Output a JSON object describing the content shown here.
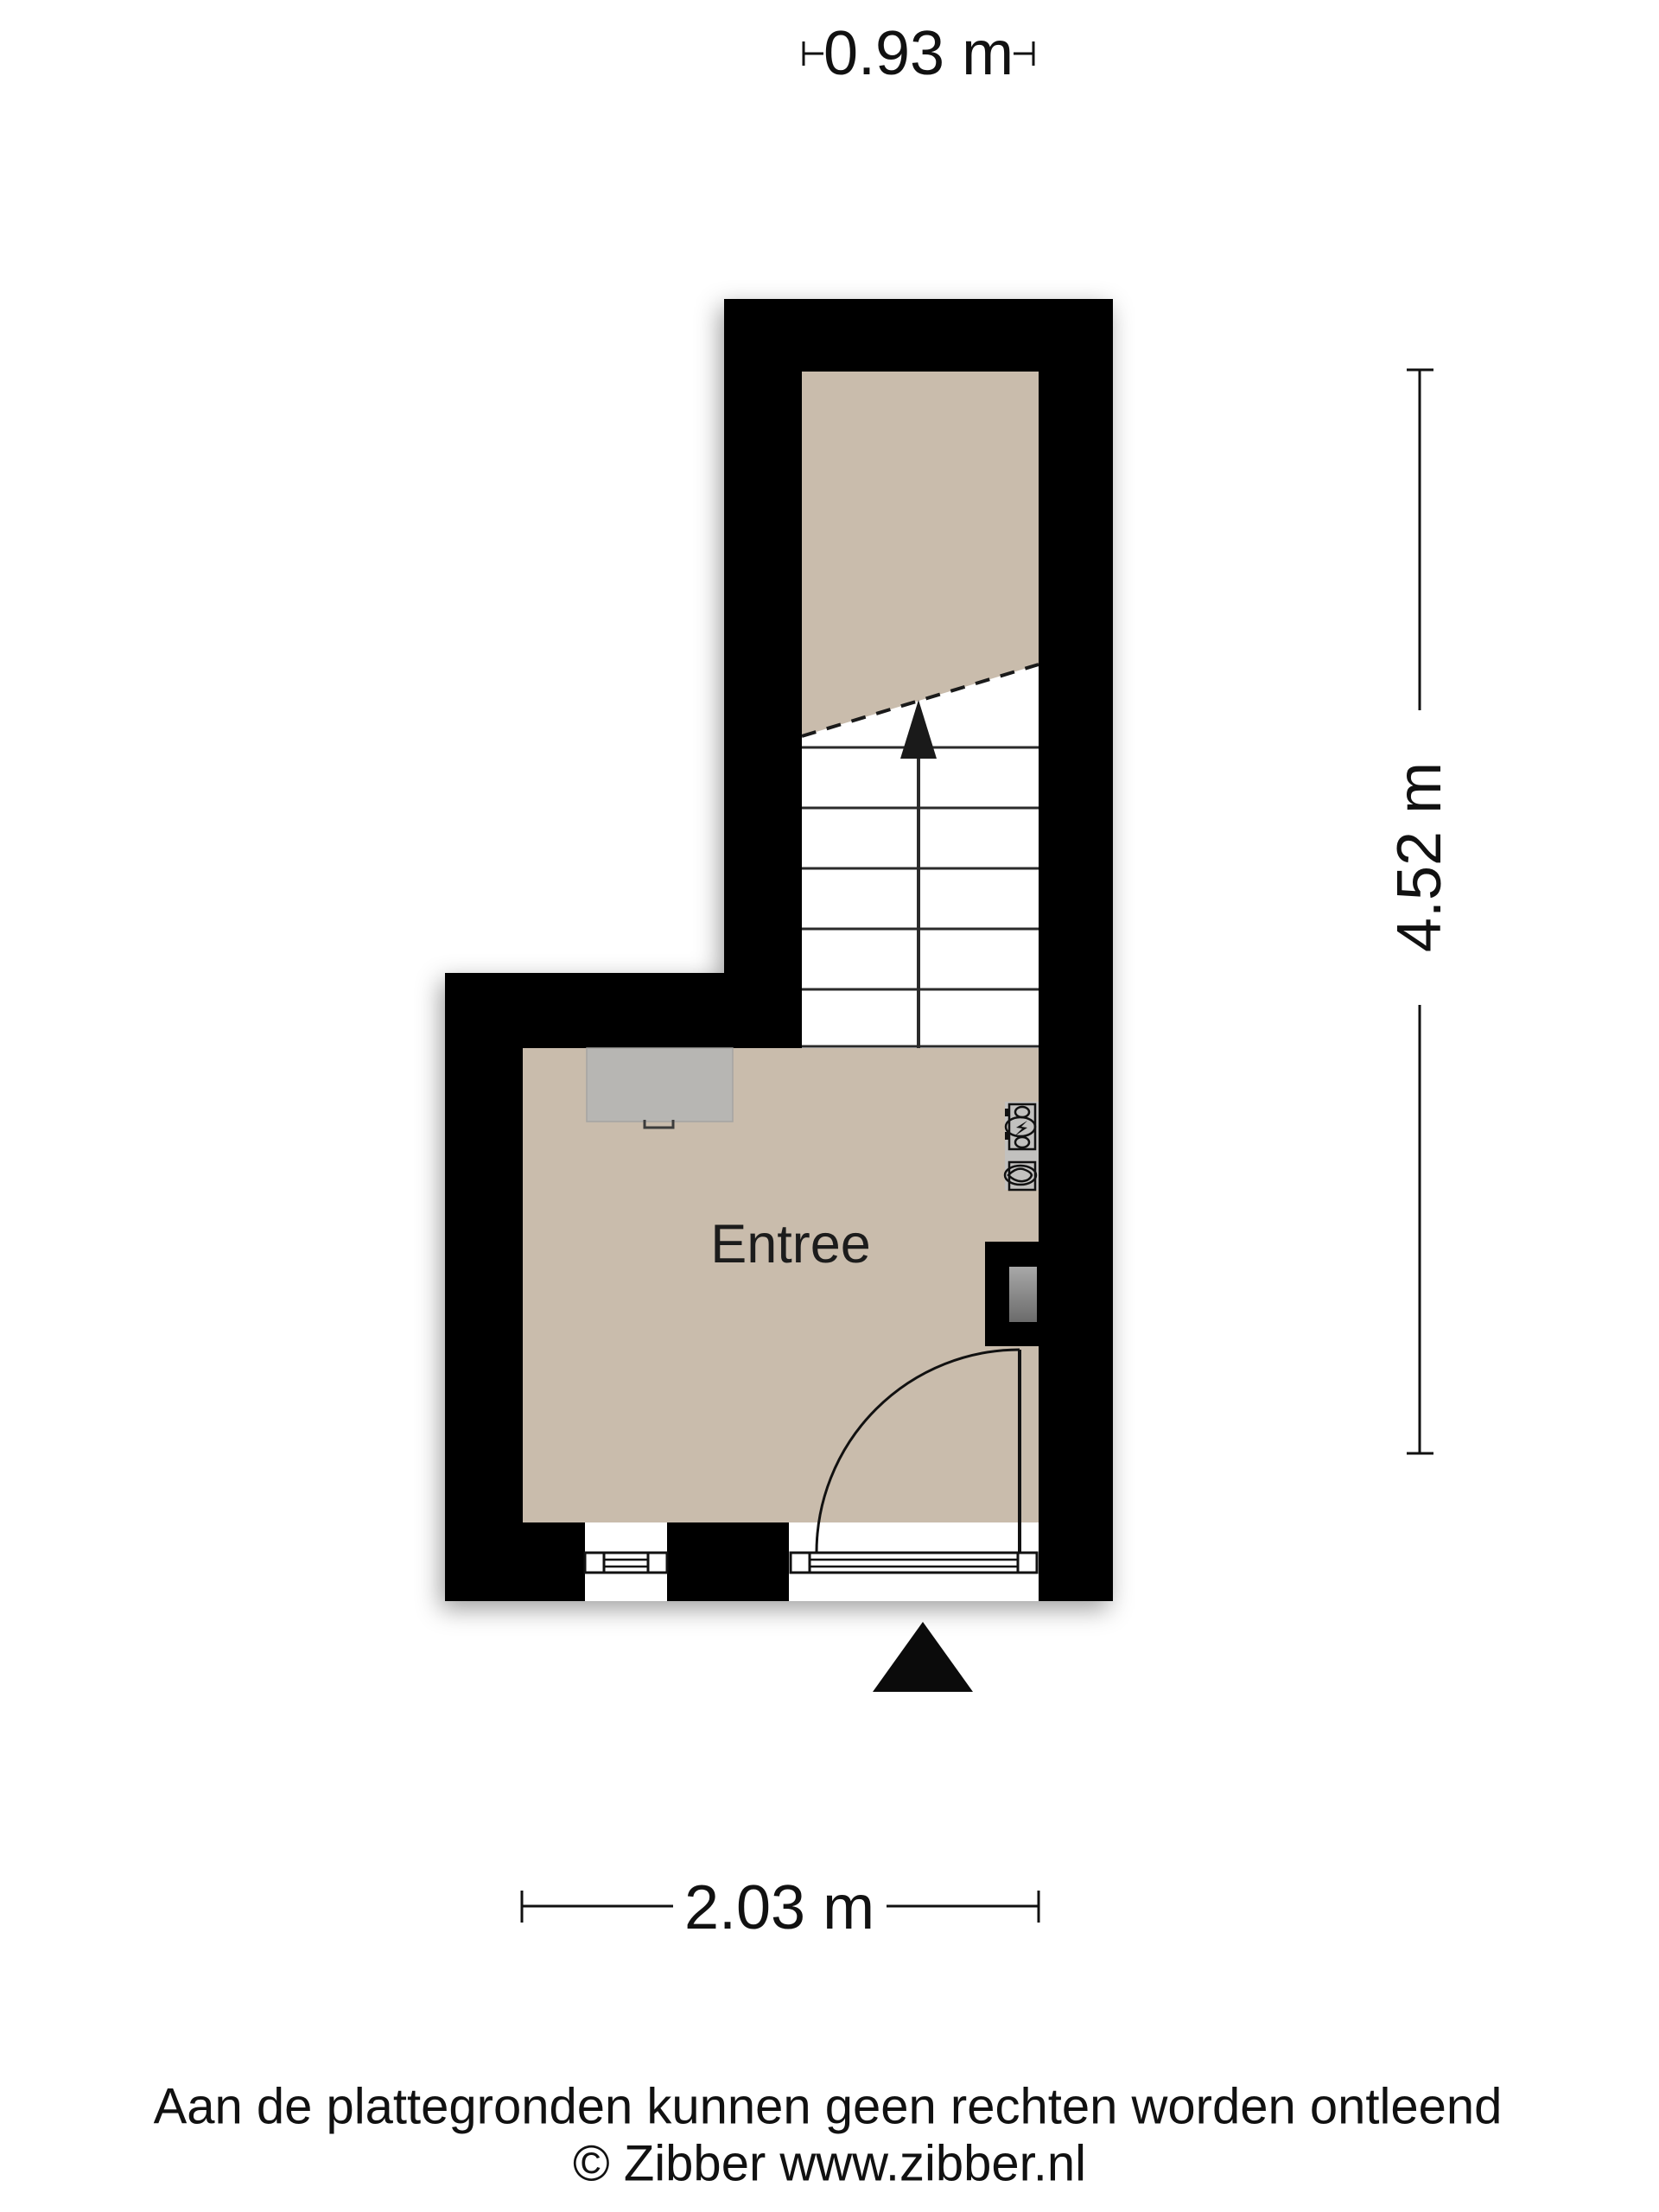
{
  "plan": {
    "room_label": "Entree"
  },
  "dimensions": {
    "top_label": "0.93 m",
    "right_label": "4.52 m",
    "bottom_label": "2.03 m"
  },
  "footer": {
    "disclaimer": "Aan de plattegronden kunnen geen rechten worden ontleend",
    "copyright": "© Zibber www.zibber.nl"
  },
  "colors": {
    "background": "#ffffff",
    "wall": "#000000",
    "floor": "#c9bcac",
    "stairs_fill": "#ffffff",
    "opening_fill": "#ffffff",
    "cabinet": "#b7b6b3",
    "flue_light": "#a8a8a8",
    "flue_dark": "#6b6b6b",
    "line": "#111111"
  }
}
